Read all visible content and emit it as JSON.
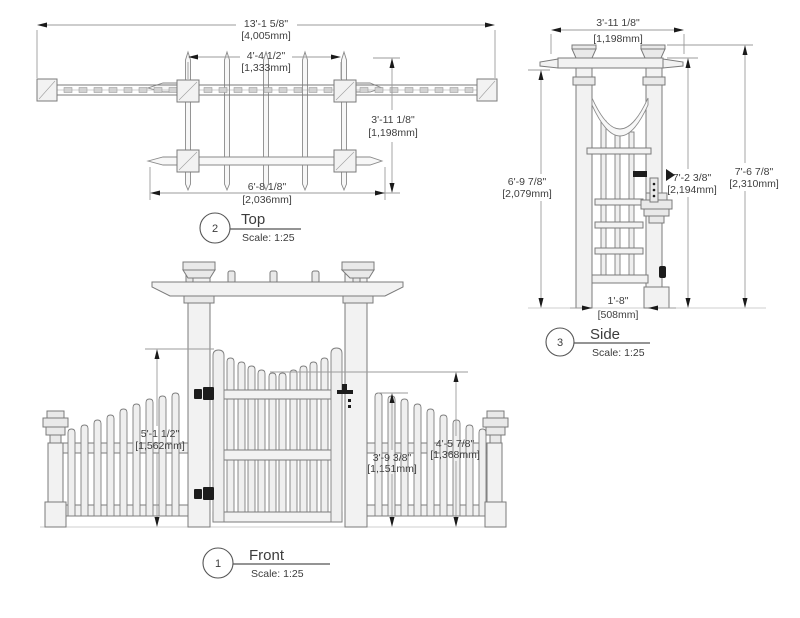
{
  "drawing_title": "Arbor with Gate and Picket Fence Wings - Orthographic Views",
  "colors": {
    "line": "#7b7b7b",
    "dim_line": "#9b9b9b",
    "dim_text": "#404040",
    "arrowhead": "#1a1a1a",
    "hardware_black": "#1c1c1c",
    "fill_light": "#f2f2f2",
    "background": "#ffffff"
  },
  "views": {
    "top": {
      "number": "2",
      "title": "Top",
      "scale_label": "Scale: 1:25",
      "dims": {
        "overall_width": {
          "imperial": "13'-1 5/8\"",
          "metric": "[4,005mm]"
        },
        "post_spacing": {
          "imperial": "4'-4 1/2\"",
          "metric": "[1,333mm]"
        },
        "depth": {
          "imperial": "3'-11 1/8\"",
          "metric": "[1,198mm]"
        },
        "beam_span": {
          "imperial": "6'-8 1/8\"",
          "metric": "[2,036mm]"
        }
      }
    },
    "front": {
      "number": "1",
      "title": "Front",
      "scale_label": "Scale: 1:25",
      "dims": {
        "gate_post_height": {
          "imperial": "5'-1 1/2\"",
          "metric": "[1,562mm]"
        },
        "fence_height": {
          "imperial": "3'-9 3/8\"",
          "metric": "[1,151mm]"
        },
        "gate_center_height": {
          "imperial": "4'-5 7/8\"",
          "metric": "[1,368mm]"
        }
      }
    },
    "side": {
      "number": "3",
      "title": "Side",
      "scale_label": "Scale: 1:25",
      "dims": {
        "beam_length": {
          "imperial": "3'-11 1/8\"",
          "metric": "[1,198mm]"
        },
        "post_height": {
          "imperial": "6'-9 7/8\"",
          "metric": "[2,079mm]"
        },
        "beam_top_height": {
          "imperial": "7'-2 3/8\"",
          "metric": "[2,194mm]"
        },
        "overall_height": {
          "imperial": "7'-6 7/8\"",
          "metric": "[2,310mm]"
        },
        "post_gap": {
          "imperial": "1'-8\"",
          "metric": "[508mm]"
        }
      }
    }
  }
}
